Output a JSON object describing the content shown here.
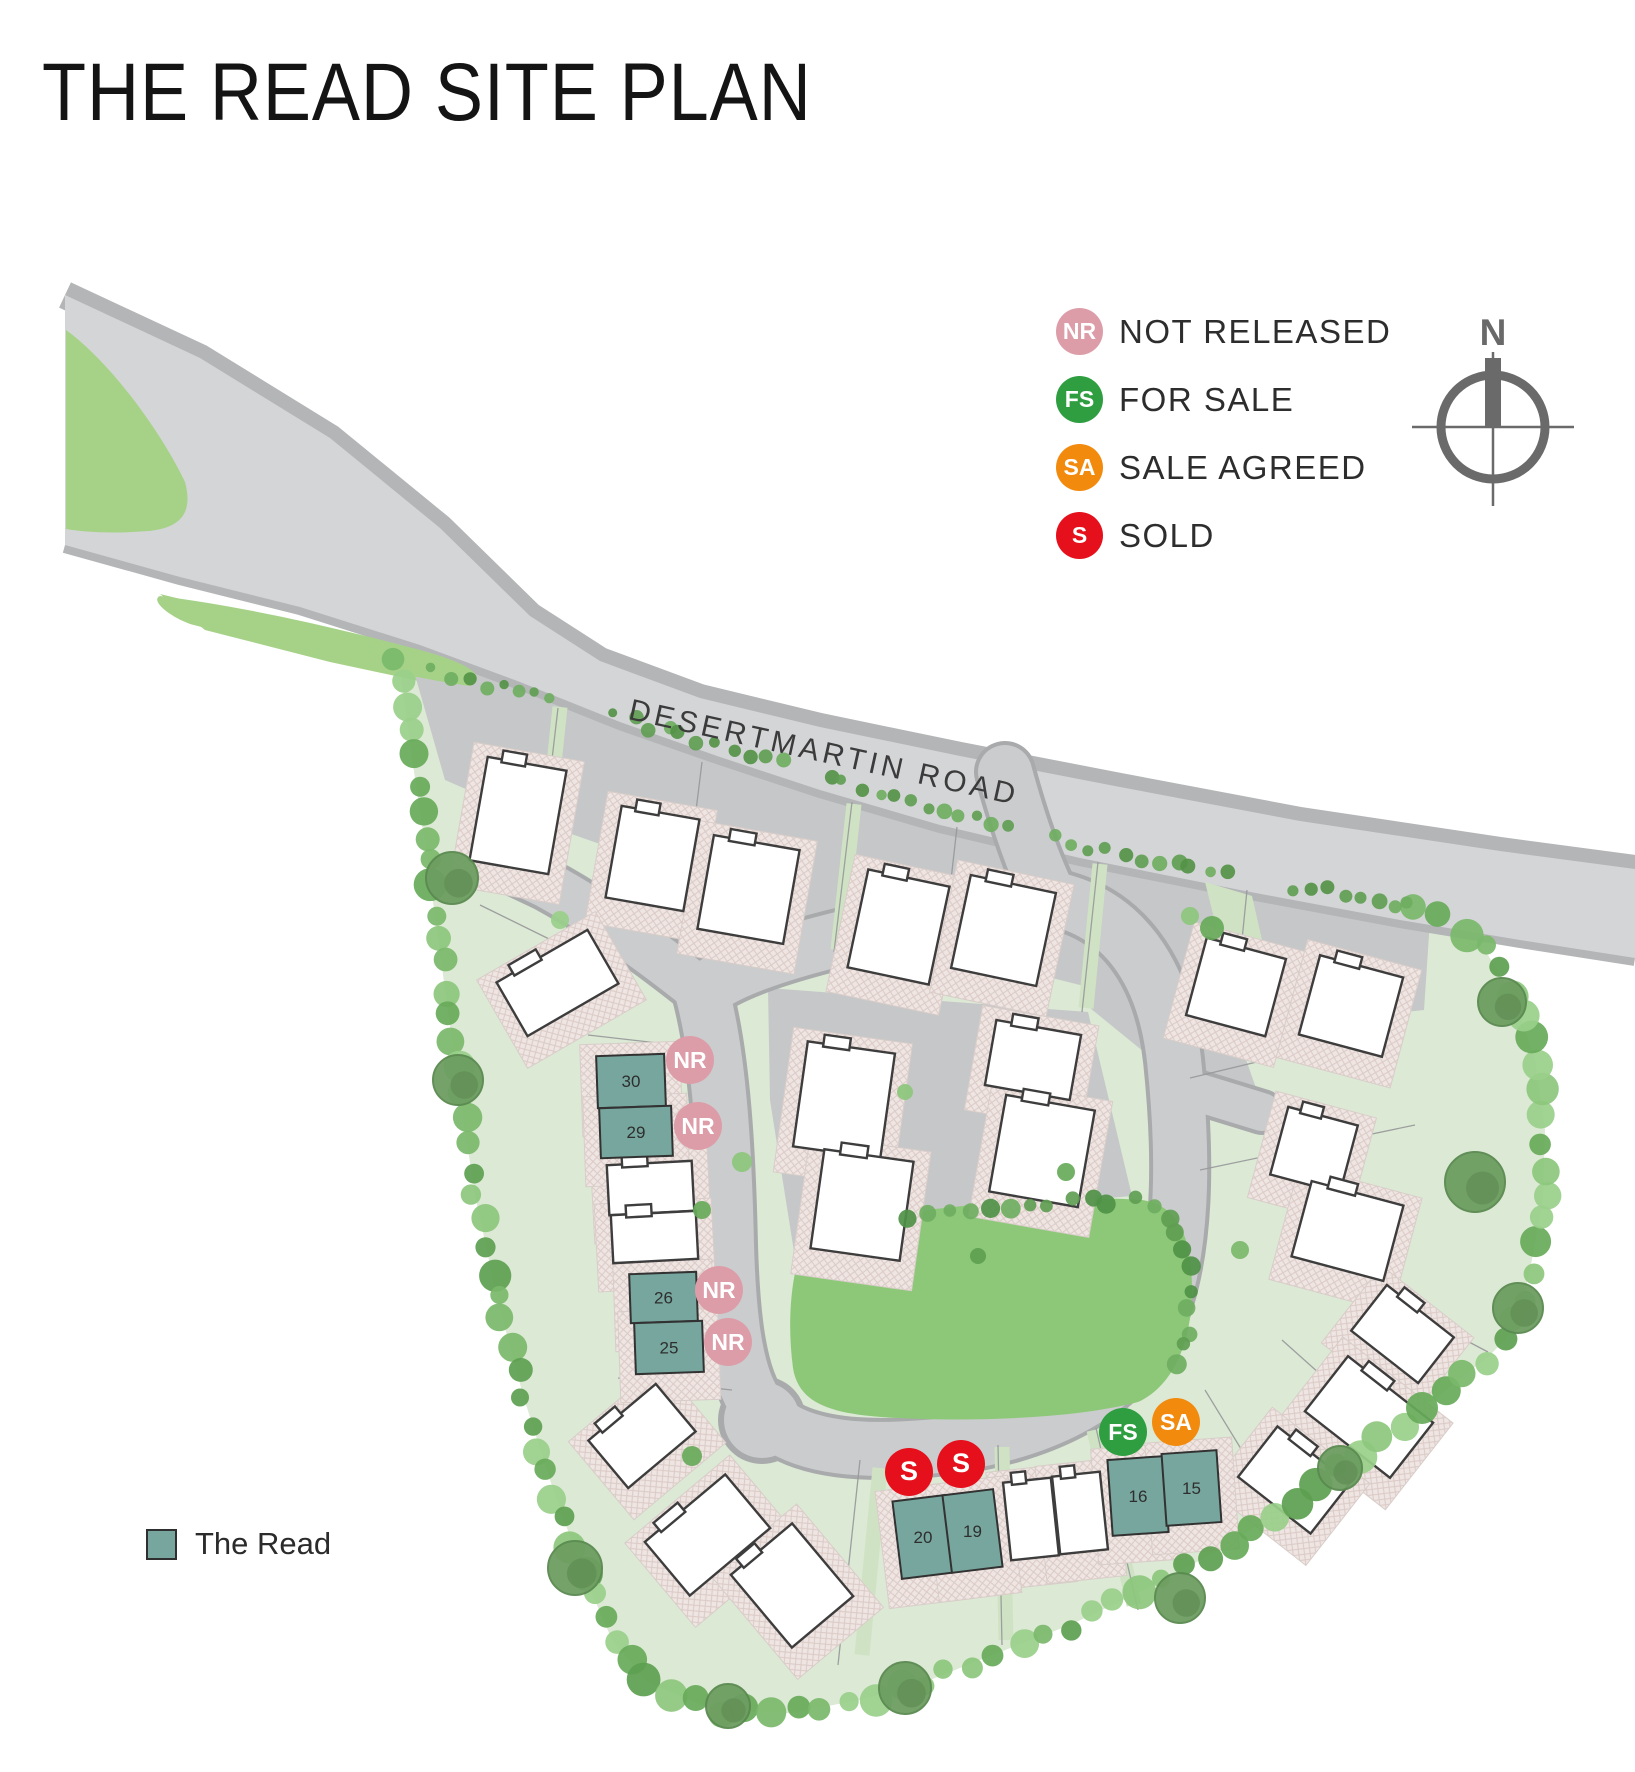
{
  "title": "THE READ SITE PLAN",
  "legend": {
    "items": [
      {
        "code": "NR",
        "label": "NOT RELEASED",
        "color": "#dc9da8"
      },
      {
        "code": "FS",
        "label": "FOR SALE",
        "color": "#2e9e41"
      },
      {
        "code": "SA",
        "label": "SALE AGREED",
        "color": "#f28a0e"
      },
      {
        "code": "S",
        "label": "SOLD",
        "color": "#e5101b"
      }
    ]
  },
  "compass": {
    "label": "N"
  },
  "map": {
    "road_label": "DESERTMARTIN ROAD",
    "statuses": {
      "NR": {
        "label": "NOT RELEASED",
        "color": "#dc9da8"
      },
      "FS": {
        "label": "FOR SALE",
        "color": "#2e9e41"
      },
      "SA": {
        "label": "SALE AGREED",
        "color": "#f28a0e"
      },
      "S": {
        "label": "SOLD",
        "color": "#e5101b"
      }
    },
    "plots": [
      {
        "number": "30",
        "status": "NR",
        "x": 597,
        "y": 1055,
        "w": 68,
        "h": 52,
        "rot": -2,
        "badge_cx": 690,
        "badge_cy": 1060
      },
      {
        "number": "29",
        "status": "NR",
        "x": 600,
        "y": 1107,
        "w": 72,
        "h": 50,
        "rot": -2,
        "badge_cx": 698,
        "badge_cy": 1126
      },
      {
        "number": "26",
        "status": "NR",
        "x": 630,
        "y": 1273,
        "w": 67,
        "h": 49,
        "rot": -2,
        "badge_cx": 719,
        "badge_cy": 1290
      },
      {
        "number": "25",
        "status": "NR",
        "x": 635,
        "y": 1322,
        "w": 68,
        "h": 51,
        "rot": -2,
        "badge_cx": 728,
        "badge_cy": 1342
      },
      {
        "number": "20",
        "status": "S",
        "x": 897,
        "y": 1498,
        "w": 52,
        "h": 78,
        "rot": -7,
        "badge_cx": 909,
        "badge_cy": 1472
      },
      {
        "number": "19",
        "status": "S",
        "x": 947,
        "y": 1492,
        "w": 51,
        "h": 78,
        "rot": -7,
        "badge_cx": 961,
        "badge_cy": 1464
      },
      {
        "number": "16",
        "status": "FS",
        "x": 1110,
        "y": 1458,
        "w": 56,
        "h": 76,
        "rot": -4,
        "badge_cx": 1123,
        "badge_cy": 1432
      },
      {
        "number": "15",
        "status": "SA",
        "x": 1164,
        "y": 1452,
        "w": 55,
        "h": 72,
        "rot": -4,
        "badge_cx": 1176,
        "badge_cy": 1422
      }
    ]
  },
  "key": {
    "label": "The Read",
    "color": "#76a69d"
  }
}
